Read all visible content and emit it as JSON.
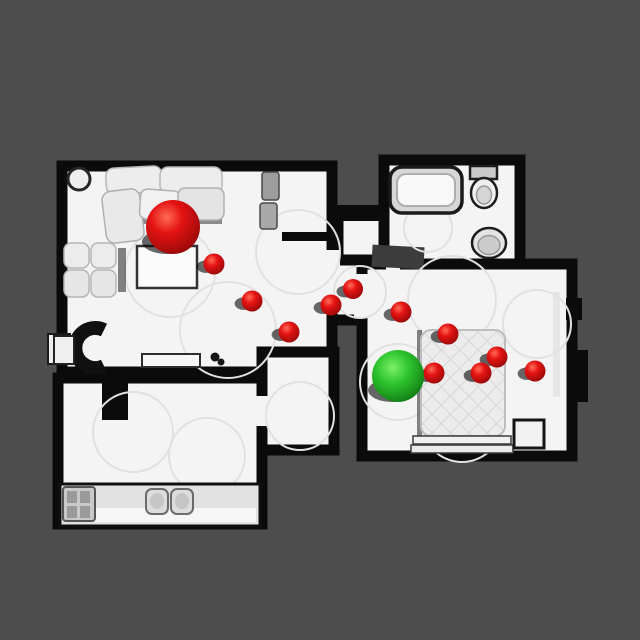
{
  "colors": {
    "background": "#4d4d4d",
    "floor": "#f4f4f4",
    "wall": "#0b0b0b",
    "floor_ring": "#e1e1e1",
    "sphere_red": "#e41313",
    "sphere_red_highlight": "#ff6b57",
    "sphere_red_dark": "#8f0808",
    "sphere_green": "#2ec52e",
    "sphere_green_highlight": "#7df06a",
    "sphere_green_dark": "#0c6e10",
    "shadow": "#060606"
  },
  "markers": {
    "start": {
      "x": 173,
      "y": 227,
      "r": 27
    },
    "goal": {
      "x": 398,
      "y": 376,
      "r": 26
    },
    "waypoint_count": 11,
    "waypoints": [
      {
        "x": 214,
        "y": 264,
        "r": 10.5
      },
      {
        "x": 252,
        "y": 301,
        "r": 10.5
      },
      {
        "x": 289,
        "y": 332,
        "r": 10.5
      },
      {
        "x": 331,
        "y": 305,
        "r": 10.5
      },
      {
        "x": 353,
        "y": 289,
        "r": 10
      },
      {
        "x": 401,
        "y": 312,
        "r": 10.5
      },
      {
        "x": 448,
        "y": 334,
        "r": 10.5
      },
      {
        "x": 497,
        "y": 357,
        "r": 10.5
      },
      {
        "x": 535,
        "y": 371,
        "r": 10.5
      },
      {
        "x": 481,
        "y": 373,
        "r": 10.5
      },
      {
        "x": 434,
        "y": 373,
        "r": 10.5
      }
    ]
  }
}
